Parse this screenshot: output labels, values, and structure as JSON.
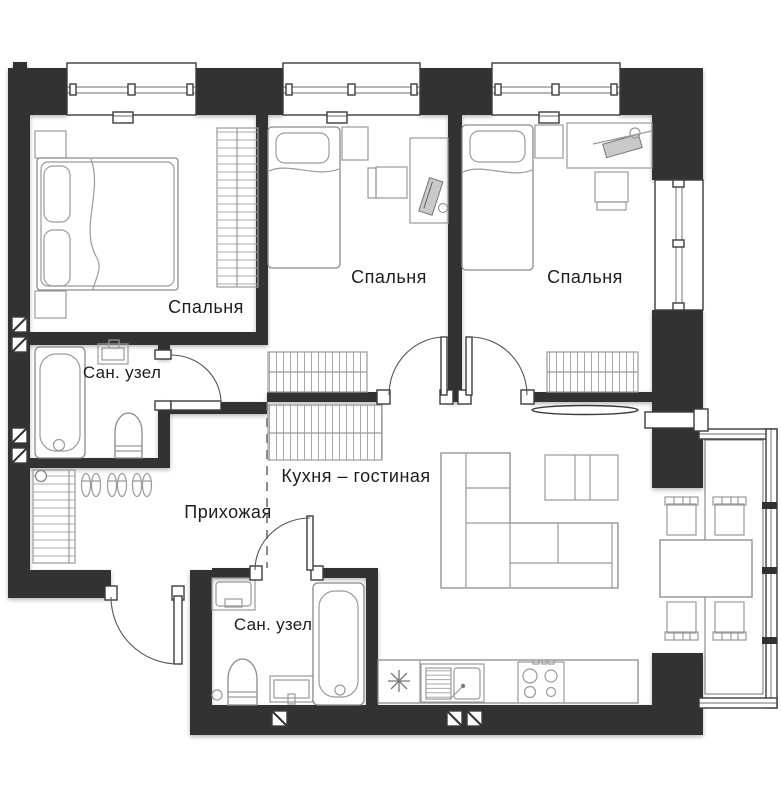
{
  "plan": {
    "type": "apartment-floor-plan",
    "rooms": [
      {
        "id": "bedroom-1",
        "label": "Спальня"
      },
      {
        "id": "bedroom-2",
        "label": "Спальня"
      },
      {
        "id": "bedroom-3",
        "label": "Спальня"
      },
      {
        "id": "bathroom-1",
        "label": "Сан. узел"
      },
      {
        "id": "bathroom-2",
        "label": "Сан. узел"
      },
      {
        "id": "hallway",
        "label": "Прихожая"
      },
      {
        "id": "kitchen-living",
        "label": "Кухня – гостиная"
      }
    ],
    "colors": {
      "background": "#ffffff",
      "wall": "#313131",
      "furniture_stroke": "#9a9a9a",
      "door_stroke": "#555555",
      "glazing_stroke": "#3c3c3c",
      "text": "#1d1d1d"
    }
  }
}
